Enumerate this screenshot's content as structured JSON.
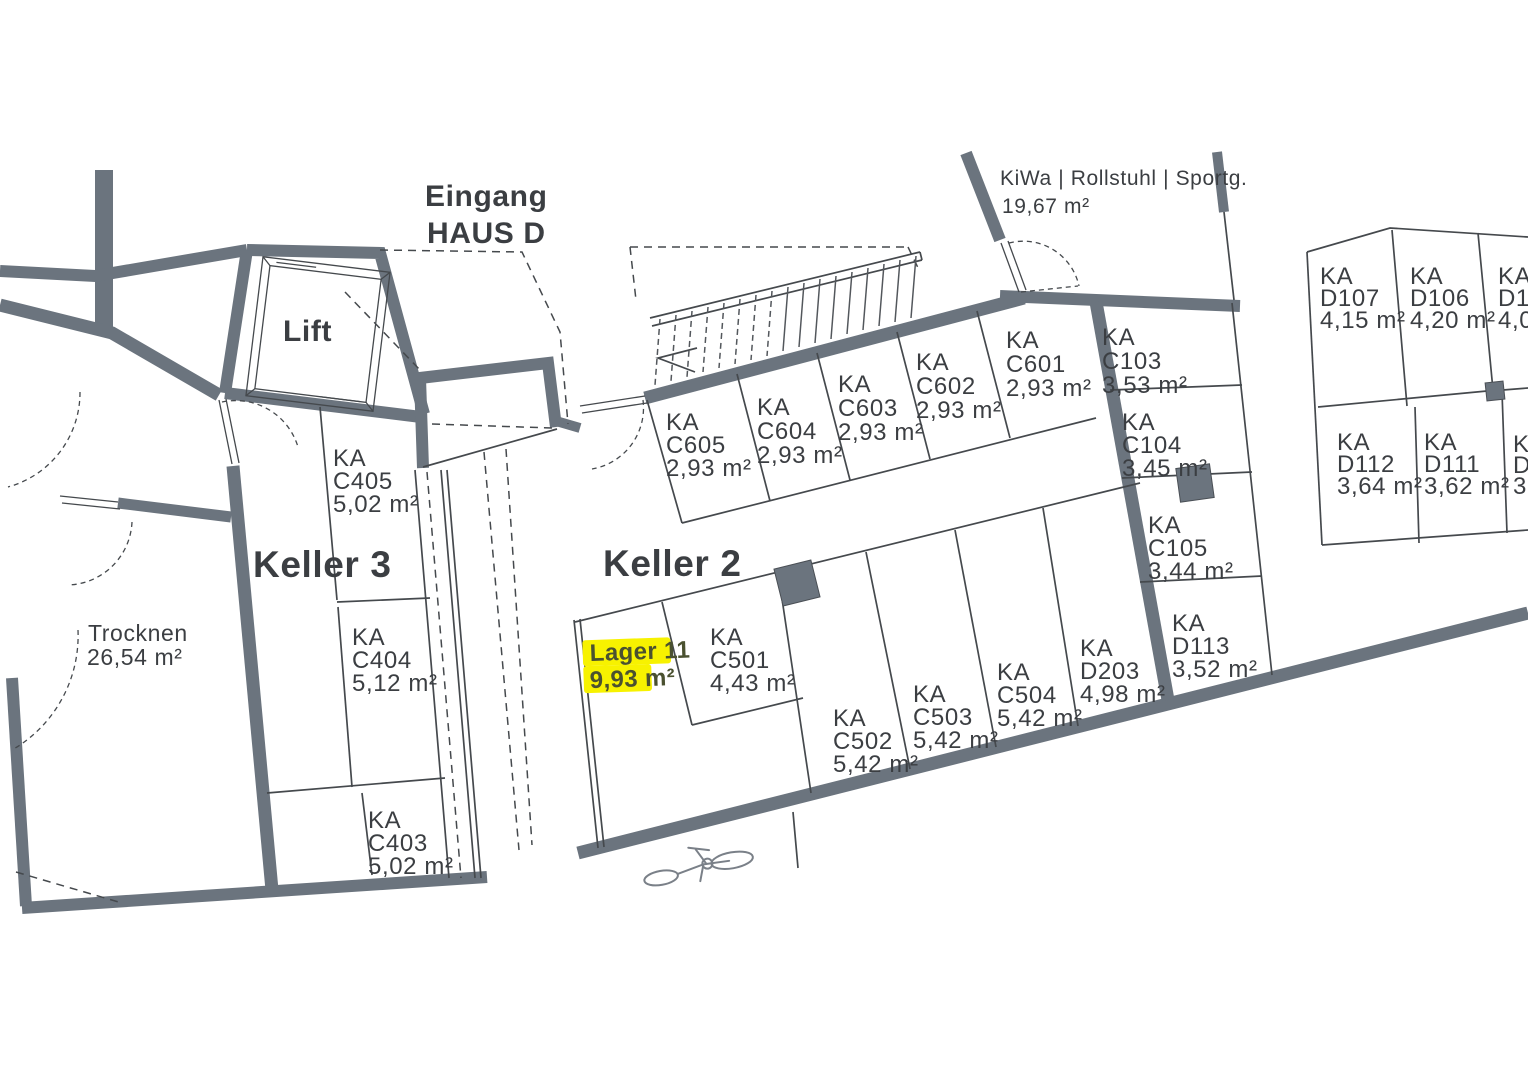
{
  "plan_title": {
    "line1": "Eingang",
    "line2": "HAUS D"
  },
  "rooms": {
    "keller3": {
      "name": "Keller 3"
    },
    "keller2": {
      "name": "Keller 2"
    },
    "lift": {
      "name": "Lift"
    },
    "trocknen": {
      "name": "Trocknen",
      "area": "26,54 m²"
    },
    "kiwa": {
      "name": "KiWa | Rollstuhl | Sportg.",
      "area": "19,67 m²"
    }
  },
  "highlighted_unit": {
    "name": "Lager 11",
    "area": "9,93 m²"
  },
  "compartments": [
    {
      "label": "KA",
      "code": "C405",
      "area": "5,02 m²"
    },
    {
      "label": "KA",
      "code": "C404",
      "area": "5,12 m²"
    },
    {
      "label": "KA",
      "code": "C403",
      "area": "5,02 m²"
    },
    {
      "label": "KA",
      "code": "C605",
      "area": "2,93 m²"
    },
    {
      "label": "KA",
      "code": "C604",
      "area": "2,93 m²"
    },
    {
      "label": "KA",
      "code": "C603",
      "area": "2,93 m²"
    },
    {
      "label": "KA",
      "code": "C602",
      "area": "2,93 m²"
    },
    {
      "label": "KA",
      "code": "C601",
      "area": "2,93 m²"
    },
    {
      "label": "KA",
      "code": "C103",
      "area": "3,53 m²"
    },
    {
      "label": "KA",
      "code": "C104",
      "area": "3,45 m²"
    },
    {
      "label": "KA",
      "code": "C105",
      "area": "3,44 m²"
    },
    {
      "label": "KA",
      "code": "D113",
      "area": "3,52 m²"
    },
    {
      "label": "KA",
      "code": "C501",
      "area": "4,43 m²"
    },
    {
      "label": "KA",
      "code": "C502",
      "area": "5,42 m²"
    },
    {
      "label": "KA",
      "code": "C503",
      "area": "5,42 m²"
    },
    {
      "label": "KA",
      "code": "C504",
      "area": "5,42 m²"
    },
    {
      "label": "KA",
      "code": "D203",
      "area": "4,98 m²"
    },
    {
      "label": "KA",
      "code": "D107",
      "area": "4,15 m²"
    },
    {
      "label": "KA",
      "code": "D106",
      "area": "4,20 m²"
    },
    {
      "label": "KA",
      "code": "D10",
      "area": "4,0"
    },
    {
      "label": "KA",
      "code": "D112",
      "area": "3,64 m²"
    },
    {
      "label": "KA",
      "code": "D111",
      "area": "3,62 m²"
    },
    {
      "label": "KA",
      "code": "D",
      "area": "3,"
    }
  ],
  "colors": {
    "wall": "#6b747e",
    "line": "#45494d",
    "text": "#3b3e42",
    "highlight": "#f7f200",
    "highlight_text": "#4a5130",
    "background": "#ffffff"
  }
}
